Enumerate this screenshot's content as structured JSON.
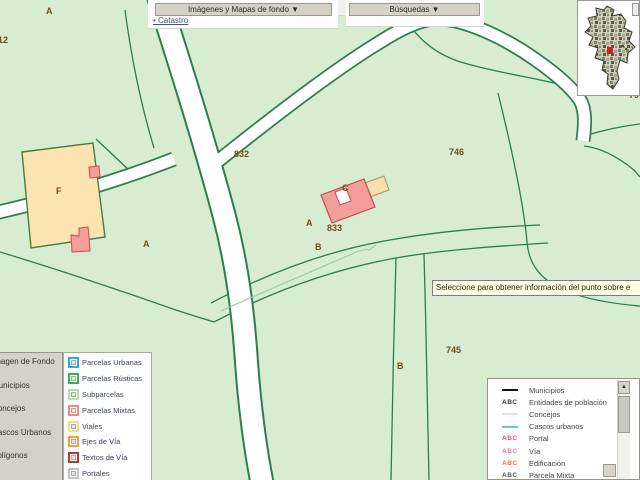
{
  "colors": {
    "map_background": "#d8ecd1",
    "parcel_line_green": "#2e7d4e",
    "road_fill": "#ffffff",
    "building_fill": "#f59d9b",
    "building_border": "#c0504d",
    "mixed_parcel_fill": "#fbe3b2",
    "map_label_brown": "#7a4a1a",
    "toolbar_button_bg": "#d5d1c8",
    "overview_highlight_red": "#cc2222",
    "tooltip_bg": "#ffffe1"
  },
  "toolbar": {
    "backgrounds_button": "Imágenes y Mapas de fondo ▼",
    "search_button": "Búsquedas ▼",
    "catastro_link": "• Catastro"
  },
  "map": {
    "tooltip_text": "Seleccione para obtener información del punto sobre e",
    "parcel_labels": [
      {
        "text": "A"
      },
      {
        "text": "712"
      },
      {
        "text": "832"
      },
      {
        "text": "746"
      },
      {
        "text": "F"
      },
      {
        "text": "C"
      },
      {
        "text": "A"
      },
      {
        "text": "A"
      },
      {
        "text": "833"
      },
      {
        "text": "B"
      },
      {
        "text": "745"
      },
      {
        "text": "B"
      },
      {
        "text": "79"
      }
    ]
  },
  "legend_left": {
    "categories": [
      {
        "label": "Imagen de Fondo"
      },
      {
        "label": "Municipios"
      },
      {
        "label": "Concejos"
      },
      {
        "label": "Cascos Urbanos"
      },
      {
        "label": "Polígonos"
      }
    ],
    "layers": [
      {
        "label": "Parcelas Urbanas",
        "color": "#2fa8dc"
      },
      {
        "label": "Parcelas Rústicas",
        "color": "#3aae49"
      },
      {
        "label": "Subparcelas",
        "color": "#b9dfa9"
      },
      {
        "label": "Parcelas Mixtas",
        "color": "#ef8a80"
      },
      {
        "label": "Viales",
        "color": "#efe08a"
      },
      {
        "label": "Ejes de Vía",
        "color": "#f59d3b"
      },
      {
        "label": "Textos de Vía",
        "color": "#b03a2e"
      },
      {
        "label": "Portales",
        "color": "#c4c4c4"
      }
    ]
  },
  "legend_right": {
    "abc_text": "ABC",
    "scroll_up_icon": "▲",
    "items": [
      {
        "symbol": "line",
        "color": "#111111",
        "label": "Municipios"
      },
      {
        "symbol": "abc",
        "color": "#333333",
        "label": "Entidades de población"
      },
      {
        "symbol": "line",
        "color": "#e2e2e2",
        "label": "Concejos"
      },
      {
        "symbol": "line",
        "color": "#6cc5d5",
        "label": "Cascos urbanos"
      },
      {
        "symbol": "abc",
        "color": "#e84f8c",
        "label": "Portal"
      },
      {
        "symbol": "abc",
        "color": "#ef7fa5",
        "label": "Vía"
      },
      {
        "symbol": "abc",
        "color": "#ef6a4e",
        "label": "Edificación"
      },
      {
        "symbol": "abc",
        "color": "#555555",
        "label": "Parcela Mixta"
      },
      {
        "symbol": "abc",
        "color": "#555555",
        "label": "Parcela Urbana"
      }
    ]
  }
}
